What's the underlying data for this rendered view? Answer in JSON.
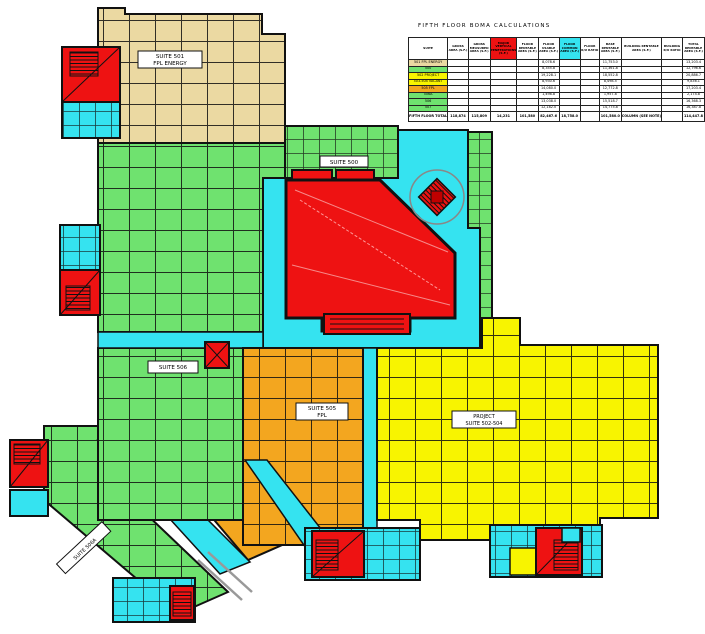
{
  "title": "FIFTH FLOOR BOMA CALCULATIONS",
  "colors": {
    "tan": "#EBD9A2",
    "green": "#6FE26F",
    "cyan": "#35E3F0",
    "red": "#EE1212",
    "darkred": "#C00000",
    "orange": "#F3A61F",
    "yellow": "#F8F400",
    "wall": "#111111",
    "gray": "#999999",
    "white": "#FFFFFF"
  },
  "plan": {
    "suite501": {
      "line1": "SUITE 501",
      "line2": "FPL ENERGY"
    },
    "suite500": {
      "label": "SUITE 500"
    },
    "suite506": {
      "label": "SUITE 506"
    },
    "suite506a": {
      "label": "SUITE 506A"
    },
    "suite505": {
      "line1": "SUITE 505",
      "line2": "FPL"
    },
    "suite502_504": {
      "line1": "PROJECT",
      "line2": "SUITE 502-504"
    }
  },
  "table": {
    "title": "FIFTH FLOOR BOMA CALCULATIONS",
    "columns": [
      {
        "label": "SUITE"
      },
      {
        "label": "GROSS AREA (S.F.)"
      },
      {
        "label": "GROSS MEASURED AREA (S.F.)"
      },
      {
        "label": "MAJOR VERTICAL PENETRATIONS (S.F.)",
        "bg": "red"
      },
      {
        "label": "FLOOR RENTABLE AREA (S.F.)"
      },
      {
        "label": "FLOOR USABLE AREA (S.F.)"
      },
      {
        "label": "FLOOR COMMON AREA (S.F.)",
        "bg": "cyan"
      },
      {
        "label": "FLOOR R/U RATIO"
      },
      {
        "label": "BASE RENTABLE AREA (S.F.)"
      },
      {
        "label": "BUILDING RENTABLE AREA (S.F.)"
      },
      {
        "label": "BUILDING R/U RATIO"
      },
      {
        "label": "TOTAL RENTABLE AREA (S.F.)"
      }
    ],
    "rows": [
      {
        "suite": "501 FPL ENERGY",
        "bg": "tan",
        "values": [
          "",
          "",
          "",
          "",
          "8,078.6",
          "",
          "",
          "11,753.0",
          "",
          "",
          "13,203.4"
        ]
      },
      {
        "suite": "500",
        "bg": "green",
        "values": [
          "",
          "",
          "",
          "",
          "8,355.8",
          "",
          "",
          "11,361.8",
          "",
          "",
          "12,796.6"
        ]
      },
      {
        "suite": "502 PROJECT",
        "bg": "yellow",
        "values": [
          "",
          "",
          "",
          "",
          "19,228.1",
          "",
          "",
          "18,552.8",
          "",
          "",
          "20,886.7"
        ]
      },
      {
        "suite": "503-504 VACANT",
        "bg": "yellow",
        "values": [
          "",
          "",
          "",
          "",
          "8,930.6",
          "",
          "",
          "8,498.5",
          "",
          "",
          "9,836.1"
        ]
      },
      {
        "suite": "505 FPL",
        "bg": "orange",
        "values": [
          "",
          "",
          "",
          "",
          "14,080.0",
          "",
          "",
          "12,772.8",
          "",
          "",
          "17,203.4"
        ]
      },
      {
        "suite": "506A",
        "bg": "green",
        "values": [
          "",
          "",
          "",
          "",
          "1,498.8",
          "",
          "",
          "1,957.8",
          "",
          "",
          "2,174.8"
        ]
      },
      {
        "suite": "506",
        "bg": "green",
        "values": [
          "",
          "",
          "",
          "",
          "13,038.0",
          "",
          "",
          "15,518.7",
          "",
          "",
          "16,368.3"
        ]
      },
      {
        "suite": "507",
        "bg": "green",
        "values": [
          "",
          "",
          "",
          "",
          "12,182.0",
          "",
          "",
          "14,775.8",
          "",
          "",
          "16,387.8"
        ]
      }
    ],
    "total": {
      "suite": "FIFTH FLOOR TOTAL",
      "values": [
        "118,874",
        "115,809",
        "14,231",
        "101,580",
        "82,467.6",
        "18,758.0",
        "",
        "101,580.0",
        "COLUMN (SEE NOTE)",
        "",
        "114,447.8"
      ]
    }
  }
}
